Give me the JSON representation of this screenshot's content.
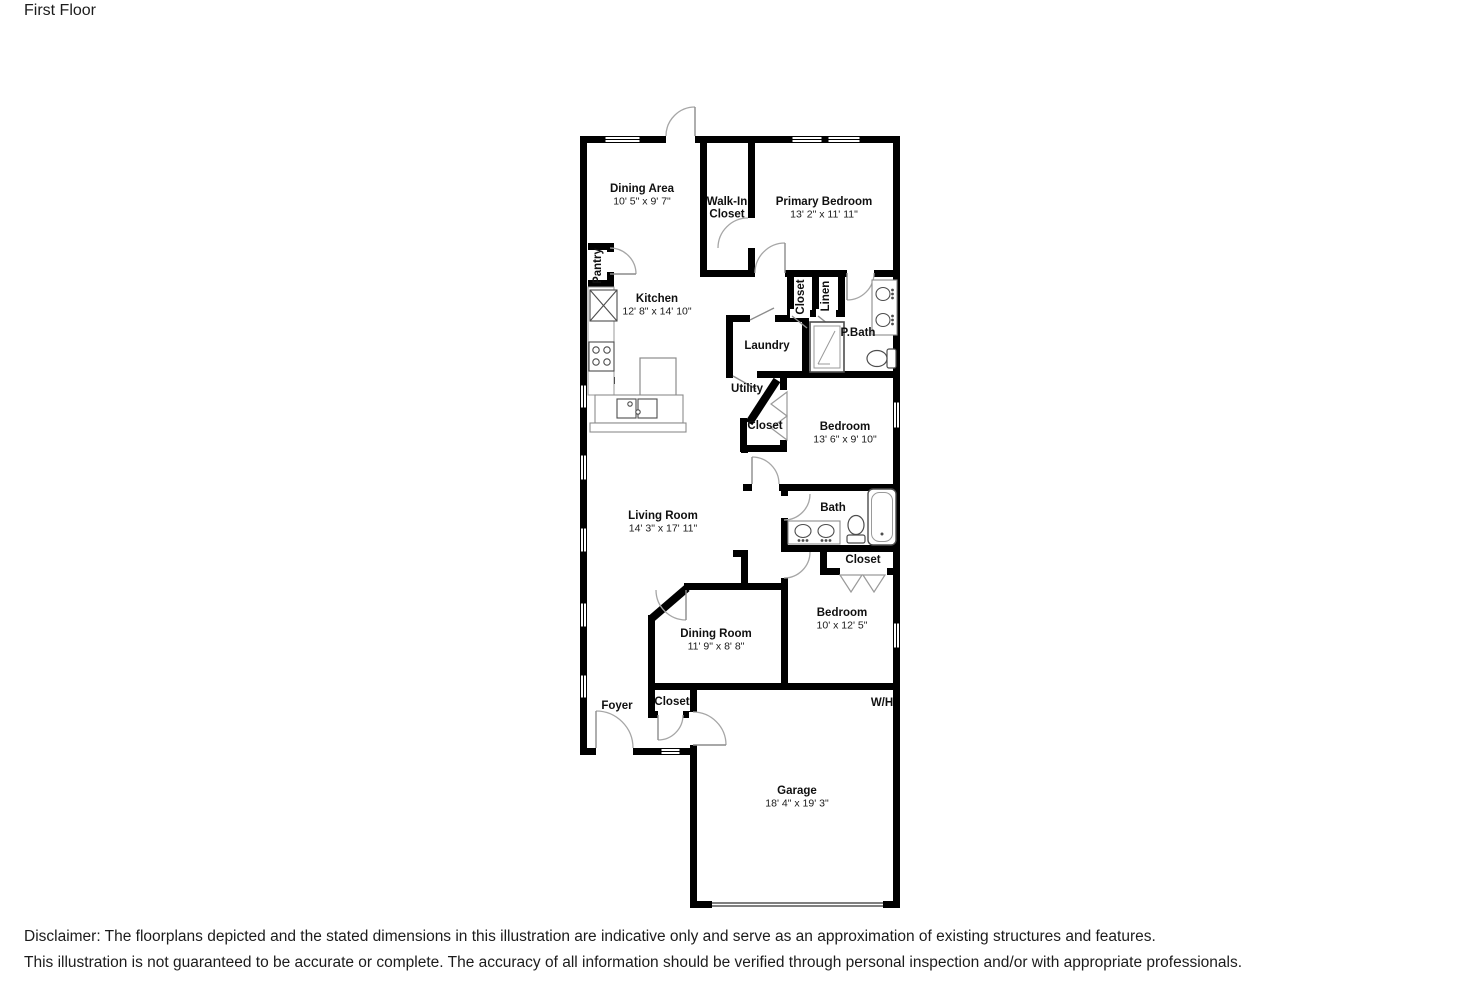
{
  "page": {
    "title": "First Floor"
  },
  "disclaimer": {
    "line1": "Disclaimer: The floorplans depicted and the stated dimensions in this illustration are indicative only and serve as an approximation of existing structures and features.",
    "line2": "This illustration is not guaranteed to be accurate or complete. The accuracy of all information should be verified through personal inspection and/or with appropriate professionals."
  },
  "colors": {
    "wall": "#000000",
    "door_arc": "#a6a6a6",
    "door_leaf": "#8c8c8c",
    "fixture_stroke": "#4d4d4d",
    "fixture_light": "#9a9a9a",
    "text": "#101010"
  },
  "floorplan": {
    "rooms": [
      {
        "id": "dining-area",
        "name": "Dining Area",
        "dims": "10' 5\" x 9' 7\"",
        "x": 642,
        "y": 192
      },
      {
        "id": "walk-in-closet",
        "name_lines": [
          "Walk-In",
          "Closet"
        ],
        "x": 727,
        "y": 205
      },
      {
        "id": "primary-bedroom",
        "name": "Primary Bedroom",
        "dims": "13' 2\" x 11' 11\"",
        "x": 824,
        "y": 205
      },
      {
        "id": "kitchen",
        "name": "Kitchen",
        "dims": "12' 8\" x 14' 10\"",
        "x": 657,
        "y": 302
      },
      {
        "id": "p-bath",
        "name": "P.Bath",
        "x": 858,
        "y": 336
      },
      {
        "id": "laundry",
        "name": "Laundry",
        "x": 767,
        "y": 349
      },
      {
        "id": "utility",
        "name": "Utility",
        "x": 747,
        "y": 392
      },
      {
        "id": "closet-utility",
        "name": "Closet",
        "x": 765,
        "y": 429
      },
      {
        "id": "bedroom-1",
        "name": "Bedroom",
        "dims": "13' 6\" x 9' 10\"",
        "x": 845,
        "y": 430
      },
      {
        "id": "living-room",
        "name": "Living Room",
        "dims": "14' 3\" x 17' 11\"",
        "x": 663,
        "y": 519
      },
      {
        "id": "bath",
        "name": "Bath",
        "x": 833,
        "y": 511
      },
      {
        "id": "closet-bath",
        "name": "Closet",
        "x": 863,
        "y": 563
      },
      {
        "id": "bedroom-2",
        "name": "Bedroom",
        "dims": "10' x 12' 5\"",
        "x": 842,
        "y": 616
      },
      {
        "id": "dining-room",
        "name": "Dining Room",
        "dims": "11' 9\" x 8' 8\"",
        "x": 716,
        "y": 637
      },
      {
        "id": "foyer",
        "name": "Foyer",
        "x": 617,
        "y": 709
      },
      {
        "id": "closet-foyer",
        "name": "Closet",
        "x": 672,
        "y": 705
      },
      {
        "id": "wh",
        "name": "W/H",
        "x": 882,
        "y": 706
      },
      {
        "id": "garage",
        "name": "Garage",
        "dims": "18' 4\" x 19' 3\"",
        "x": 797,
        "y": 794
      }
    ],
    "vertical_labels": [
      {
        "id": "pantry",
        "name": "Pantry",
        "x": 601,
        "y": 266
      },
      {
        "id": "closet-hall",
        "name": "Closet",
        "x": 804,
        "y": 297
      },
      {
        "id": "linen",
        "name": "Linen",
        "x": 829,
        "y": 296
      }
    ],
    "icons": {
      "refrigerator-icon": "rect-with-x",
      "stove-icon": "rect-with-4-burners",
      "kitchen-sink-icon": "double-bowl-rect",
      "kitchen-island": "rect",
      "shower-icon": "rect-with-glass-lines",
      "double-vanity-icon": "rect-with-2-oval-sinks",
      "toilet-icon": "oval-bowl-with-tank",
      "bathtub-icon": "rounded-rect",
      "door-swing-icon": "quarter-arc",
      "bifold-door-icon": "chevron-triangles",
      "window-icon": "white-gap-with-midline",
      "garage-door-icon": "double-parallel-lines"
    }
  }
}
